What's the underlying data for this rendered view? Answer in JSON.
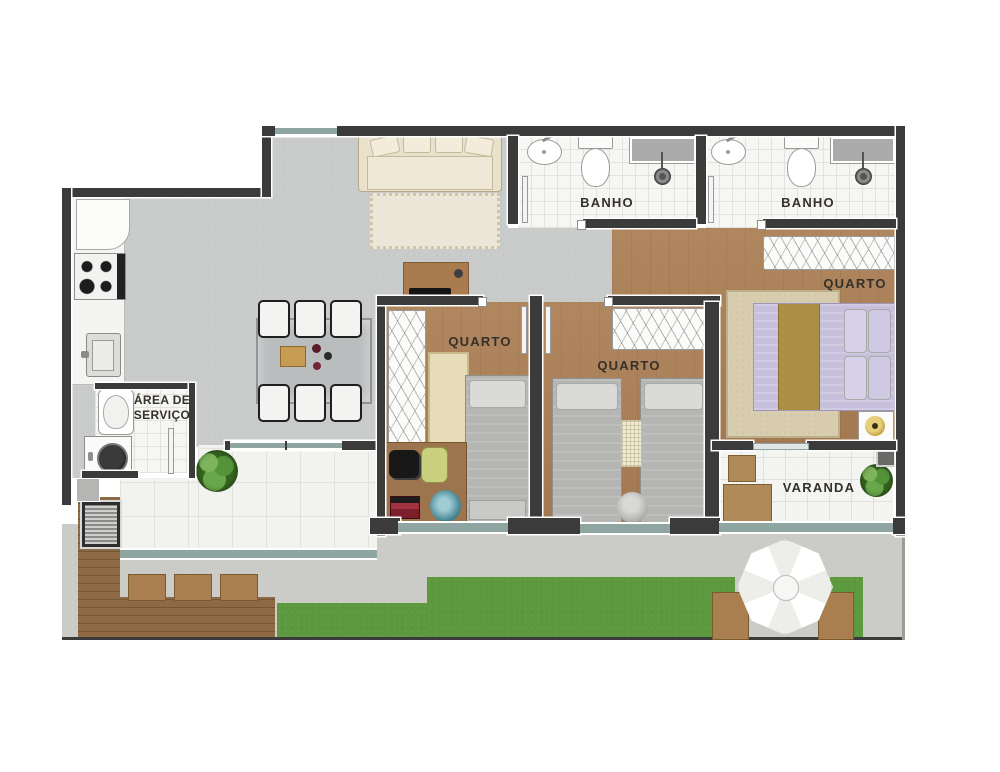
{
  "plan": {
    "kind": "residential apartment floor plan, top-down render",
    "rooms": {
      "bath1": {
        "label": "BANHO"
      },
      "bath2": {
        "label": "BANHO"
      },
      "bedroom1": {
        "label": "QUARTO"
      },
      "bedroom2": {
        "label": "QUARTO"
      },
      "master_bedroom": {
        "label": "QUARTO"
      },
      "service_area": {
        "label": "ÁREA DE SERVIÇO"
      },
      "balcony": {
        "label": "VARANDA"
      }
    },
    "palette": {
      "wall": "#3b3b3b",
      "wood_floor": "#ab7f55",
      "deck_wood": "#8d6a44",
      "indoor_concrete": "#c9cbca",
      "outdoor_concrete": "#cbcbc8",
      "white_tile": "#f2f2ef",
      "window_glass": "#8fa5a2",
      "grass": "#5d9a3f",
      "bed_gray": "#b5b6b4",
      "bed_lavender": "#c7c0dc",
      "bed_runner_gold": "#ac8f44",
      "sofa_cream": "#e9e1cc",
      "rug_teal": "#3d7f8c",
      "desk_chair_lime": "#c9d07e",
      "plant_green": "#55933a"
    }
  }
}
